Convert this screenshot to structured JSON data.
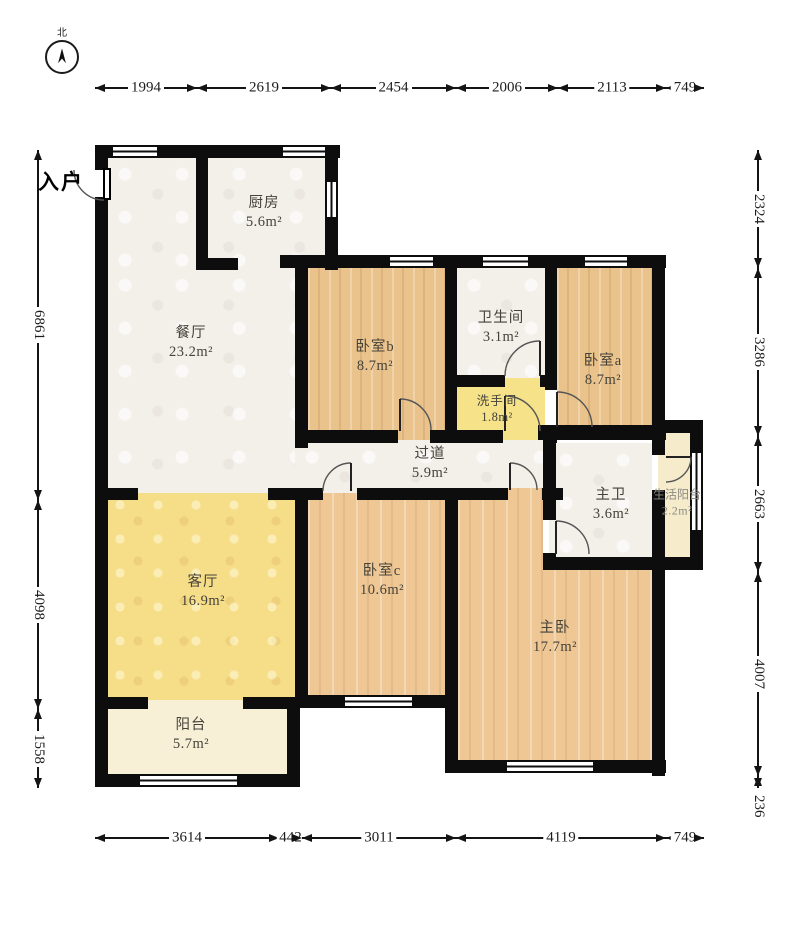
{
  "compass": {
    "label": "北"
  },
  "entrance": {
    "label": "入户"
  },
  "rooms": [
    {
      "id": "kitchen",
      "name": "厨房",
      "area": "5.6m²"
    },
    {
      "id": "dining",
      "name": "餐厅",
      "area": "23.2m²"
    },
    {
      "id": "bedroom-b",
      "name": "卧室b",
      "area": "8.7m²"
    },
    {
      "id": "bathroom",
      "name": "卫生间",
      "area": "3.1m²"
    },
    {
      "id": "bedroom-a",
      "name": "卧室a",
      "area": "8.7m²"
    },
    {
      "id": "washroom",
      "name": "洗手间",
      "area": "1.8m²"
    },
    {
      "id": "corridor",
      "name": "过道",
      "area": "5.9m²"
    },
    {
      "id": "master-bath",
      "name": "主卫",
      "area": "3.6m²"
    },
    {
      "id": "service-balcony",
      "name": "生活阳台",
      "area": "2.2m²"
    },
    {
      "id": "living",
      "name": "客厅",
      "area": "16.9m²"
    },
    {
      "id": "bedroom-c",
      "name": "卧室c",
      "area": "10.6m²"
    },
    {
      "id": "master-bedroom",
      "name": "主卧",
      "area": "17.7m²"
    },
    {
      "id": "balcony",
      "name": "阳台",
      "area": "5.7m²"
    }
  ],
  "dimensions": {
    "top": [
      "1994",
      "2619",
      "2454",
      "2006",
      "2113",
      "749"
    ],
    "bottom": [
      "3614",
      "442",
      "3011",
      "4119",
      "749"
    ],
    "left": [
      "6861",
      "4098",
      "1558"
    ],
    "right": [
      "2324",
      "3286",
      "2663",
      "4007",
      "236"
    ]
  },
  "colors": {
    "wall": "#0d0d0d",
    "wood_floor": "#eac28b",
    "wood_floor_light": "#eec795",
    "living_yellow": "#f6dd88",
    "washroom_yellow": "#f5e289",
    "balcony_cream": "#f8f0d6",
    "service_balcony_cream": "#f6eccb",
    "tile_white": "#f3f0ea"
  }
}
